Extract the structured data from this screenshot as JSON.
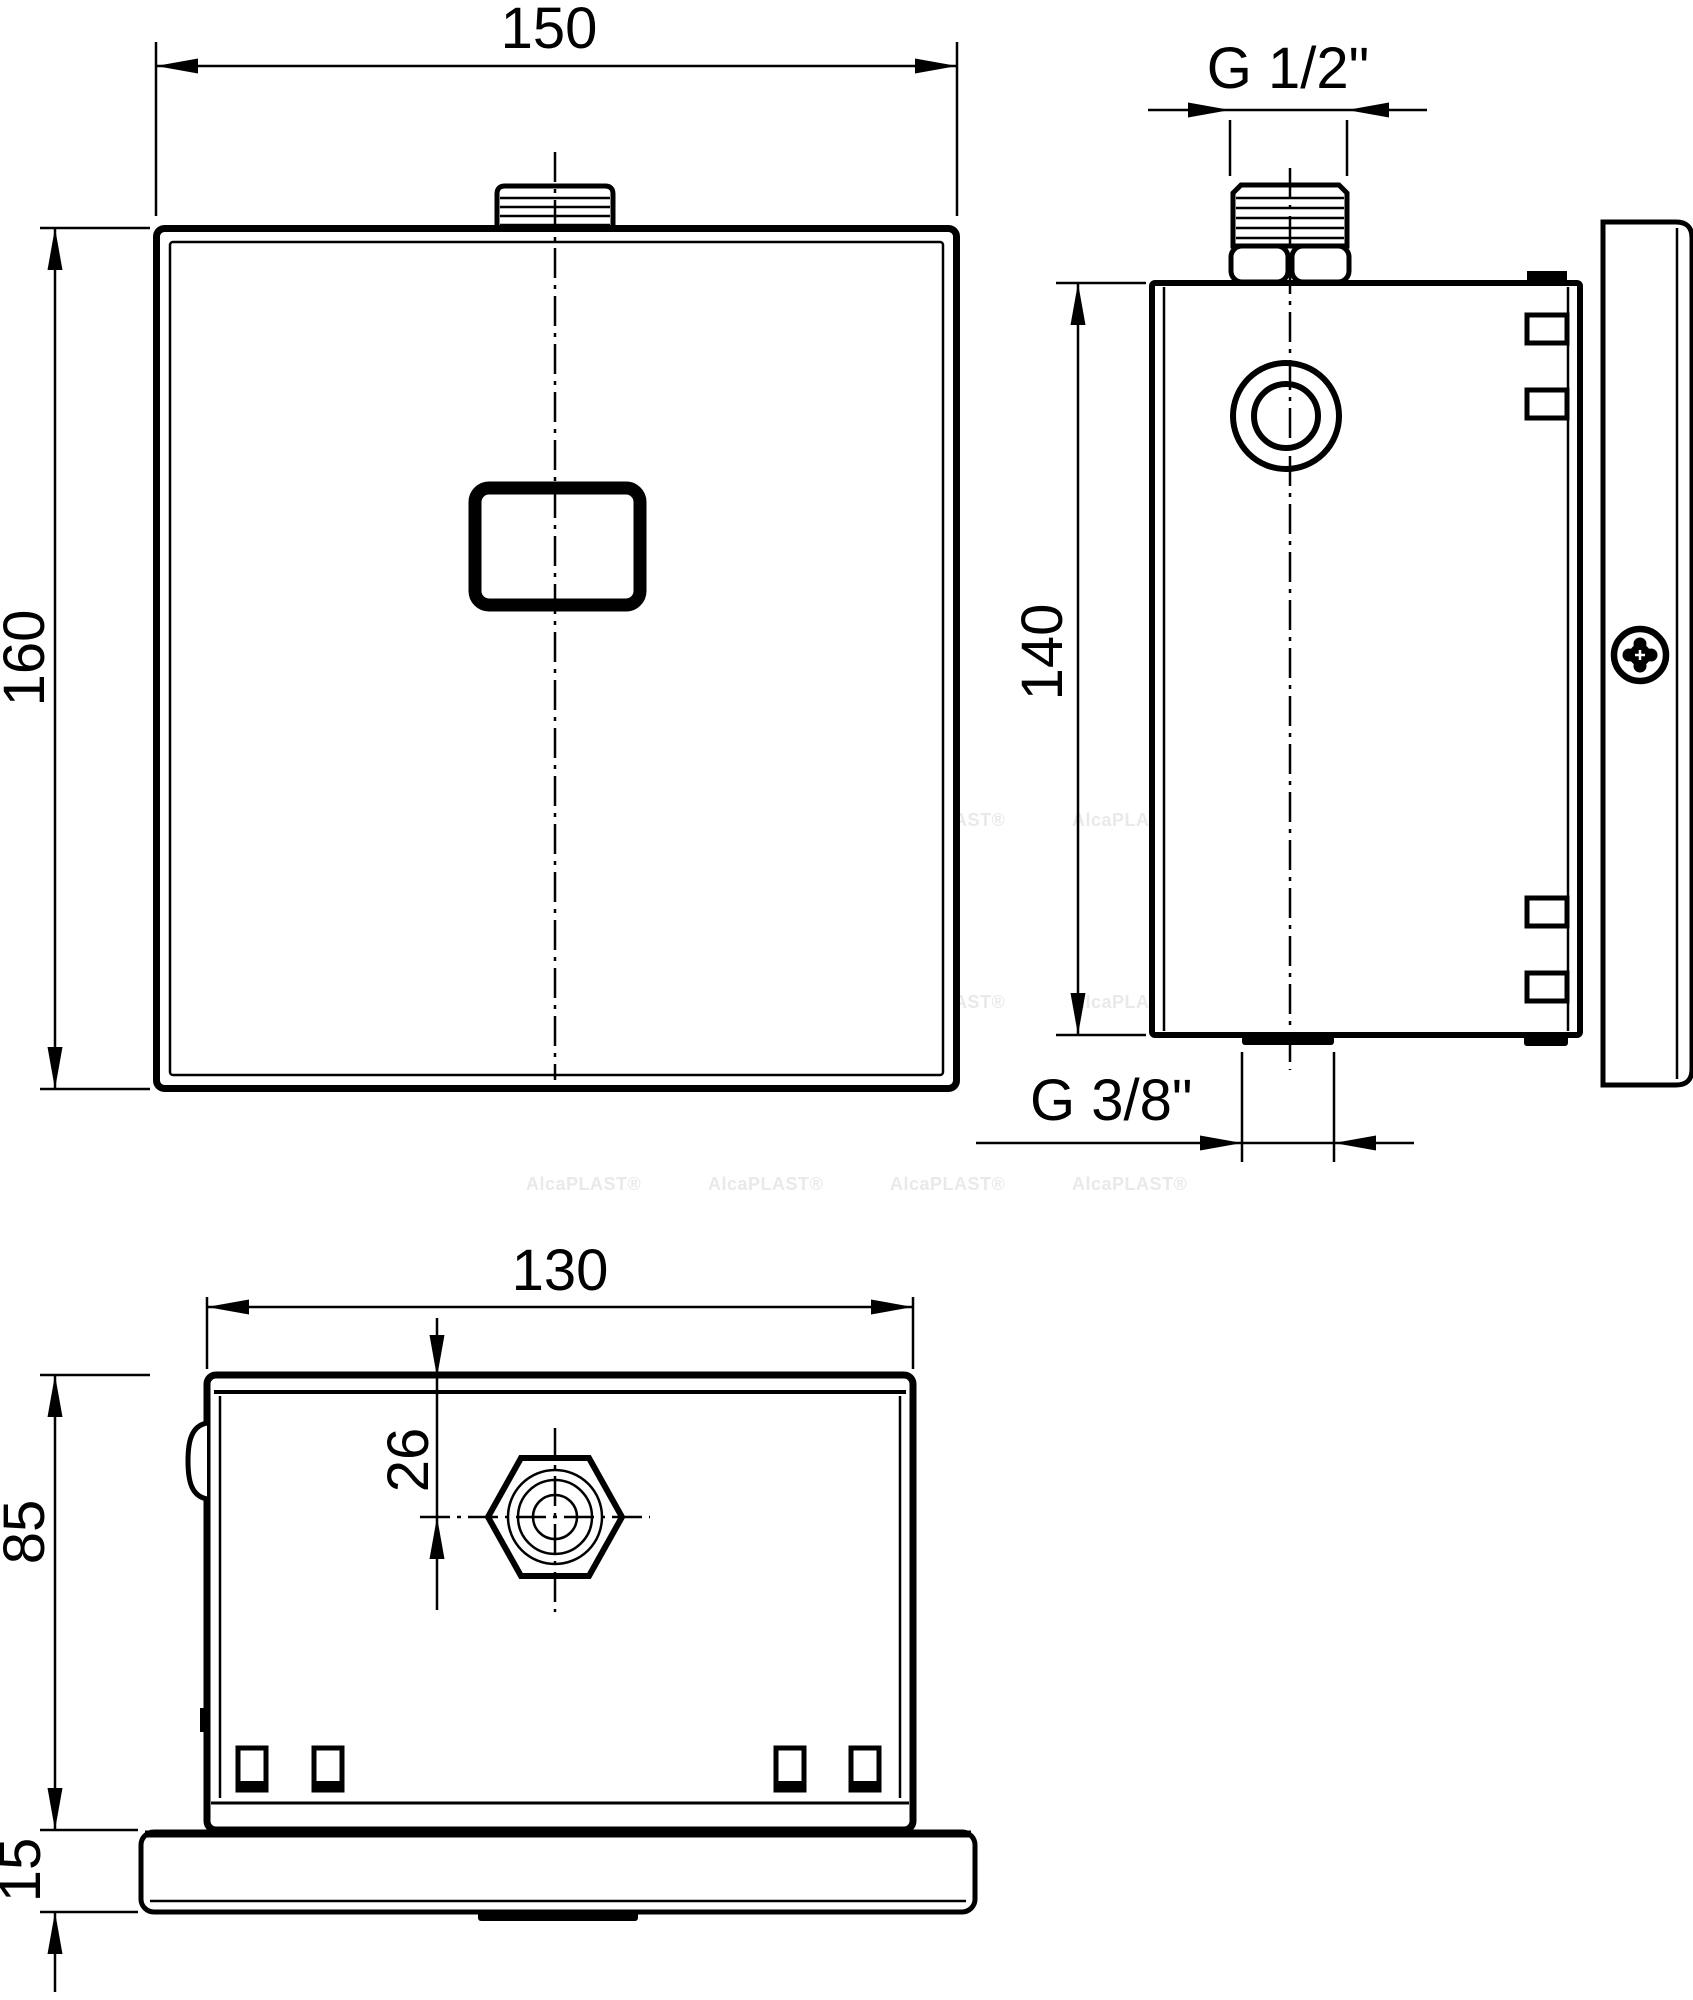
{
  "page": {
    "background": "#ffffff",
    "line_color": "#000000"
  },
  "drawing": {
    "watermark": {
      "text": "AlcaPLAST®",
      "color": "#e9e9e9"
    },
    "front_view": {
      "width_dim": "150",
      "height_dim": "160"
    },
    "side_view": {
      "top_thread_dim": "G 1/2\"",
      "height_dim": "140",
      "bottom_thread_dim": "G 3/8\""
    },
    "bottom_view": {
      "width_dim": "130",
      "inlet_offset_dim": "26",
      "depth_dim": "85",
      "flange_dim": "15"
    }
  }
}
